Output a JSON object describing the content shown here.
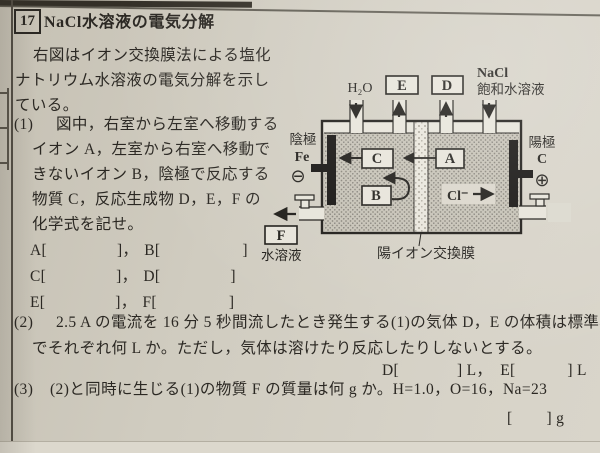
{
  "page": {
    "problem_number": "17",
    "title": "NaCl水溶液の電気分解",
    "intro_lines": [
      "右図はイオン交換膜法による塩化",
      "ナトリウム水溶液の電気分解を示し",
      "ている。"
    ],
    "q1": {
      "number": "(1)",
      "lines": [
        "図中，右室から左室へ移動する",
        "イオン A，左室から右室へ移動で",
        "きないイオン B，陰極で反応する",
        "物質 C，反応生成物 D，E，F の",
        "化学式を記せ。"
      ],
      "answer_rows": [
        {
          "open1": "A[",
          "close1": "]，",
          "open2": "B[",
          "close2": "]"
        },
        {
          "open1": "C[",
          "close1": "]，",
          "open2": "D[",
          "close2": "]"
        },
        {
          "open1": "E[",
          "close1": "]，",
          "open2": "F[",
          "close2": "]"
        }
      ]
    },
    "q2": {
      "number": "(2)",
      "line1": "2.5 A の電流を 16 分 5 秒間流したとき発生する(1)の気体 D，E の体積は標準状態",
      "line2": "でそれぞれ何 L か。ただし，気体は溶けたり反応したりしないとする。",
      "answer": {
        "open1": "D[",
        "close1": "] L，",
        "open2": "E[",
        "close2": "] L"
      }
    },
    "q3": {
      "number": "(3)",
      "line1": "(2)と同時に生じる(1)の物質 F の質量は何 g か。H=1.0，O=16，Na=23",
      "answer": {
        "open": "[",
        "close": "] g"
      }
    }
  },
  "diagram": {
    "inlet_left": "H₂O",
    "outlet_left_box": "E",
    "outlet_right_box": "D",
    "inlet_right_line1": "NaCl",
    "inlet_right_line2": "飽和水溶液",
    "cathode_label": "陰極",
    "cathode_material": "Fe",
    "cathode_sign": "⊖",
    "anode_label": "陽極",
    "anode_material": "C",
    "anode_sign": "⊕",
    "box_c": "C",
    "box_a": "A",
    "box_b": "B",
    "cl_ion": "Cl⁻",
    "f_box": "F",
    "f_caption": "水溶液",
    "membrane_label": "陽イオン交換膜"
  },
  "colors": {
    "paper": "#d0ccc0",
    "ink": "#2b2823",
    "electrode": "#141210",
    "stipple_base": "#c6c2b6"
  }
}
